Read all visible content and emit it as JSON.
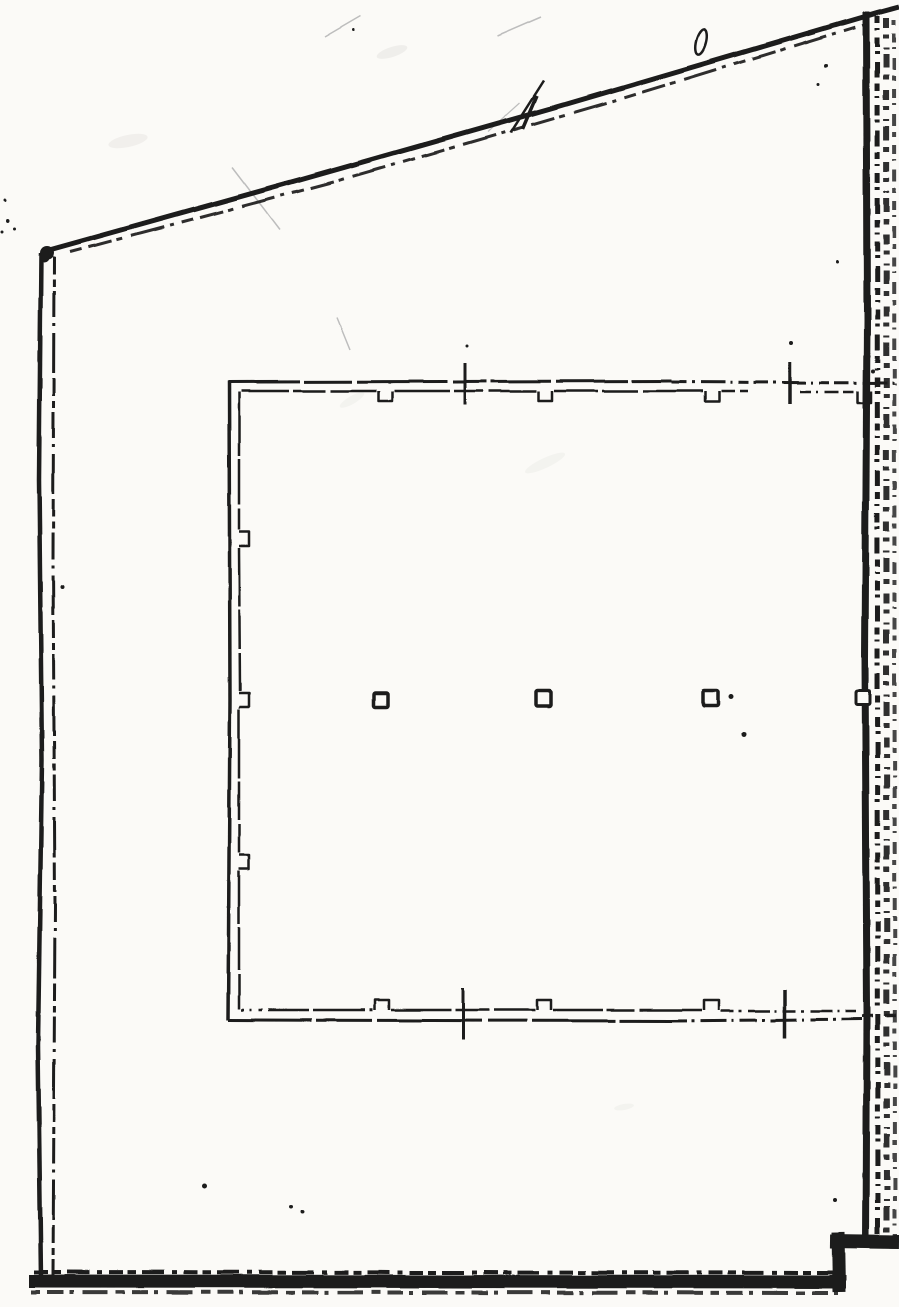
{
  "document": {
    "title": "Scanned architectural floor plan sketch",
    "description": "Photocopied hand-drafted plan: outer boundary with sloped top line, thick textured right and bottom walls, inner slab outline with formwork notches, three column squares and section tick marks. No text labels visible."
  },
  "canvas": {
    "width": 899,
    "height": 1307
  },
  "colors": {
    "paper": "#fbfaf7",
    "ink": "#1b1b1b",
    "scratch": "#bdbdbd",
    "smudge": "#d9d8d3"
  },
  "drawing": {
    "strokes": [
      {
        "n": "left-wall-outer-line",
        "d": "M41,253 L39,480 L42,760 L38,1045 L41,1279",
        "w": 4.5
      },
      {
        "n": "left-wall-inner-line",
        "d": "M54,257 L53,560 L55,905 L53,1276",
        "w": 3,
        "dash": "18 5 7 4 26 6 3 7 40 5"
      },
      {
        "n": "roof-line-main",
        "d": "M42,252 L300,180 L560,106 L877,13 L899,7",
        "w": 5
      },
      {
        "n": "roof-line-rough",
        "d": "M70,252 L330,183 L610,102 L866,24",
        "w": 3,
        "dash": "12 7 24 5 6 9 34 6 4 8",
        "o": 0.9
      },
      {
        "n": "right-wall-core",
        "d": "M866,12 L867,320 L865,660 L867,1010 L866,1246",
        "w": 7
      },
      {
        "n": "right-wall-texture-1",
        "d": "M877,16 L878,1245",
        "w": 5,
        "dash": "7 5 2 7 10 4 3 8 16 6"
      },
      {
        "n": "right-wall-texture-2",
        "d": "M886,18 L887,1243",
        "w": 6,
        "dash": "10 6 4 9 2 5 14 7 5 10",
        "o": 0.92
      },
      {
        "n": "right-wall-texture-3",
        "d": "M894,20 L895,1238",
        "w": 4,
        "dash": "5 8 9 5 2 9 12 6",
        "o": 0.8
      },
      {
        "n": "bottom-wall-core",
        "d": "M29,1281 L846,1282",
        "w": 13
      },
      {
        "n": "bottom-wall-texture-top",
        "d": "M34,1272 L842,1273",
        "w": 4,
        "dash": "14 5 8 6 22 8 5 7"
      },
      {
        "n": "bottom-wall-texture-bottom",
        "d": "M31,1292 L838,1293",
        "w": 4,
        "dash": "9 7 16 6 4 9 26 8",
        "o": 0.85
      },
      {
        "n": "bottom-step-riser",
        "d": "M838,1232 L839,1292",
        "w": 13
      },
      {
        "n": "bottom-step-ledge",
        "d": "M830,1241 L899,1242",
        "w": 14
      },
      {
        "n": "slab-top-outer-line",
        "d": "M228,382 L672,381",
        "w": 3,
        "dash": "72 4 48 5 90 6 34 4 60 5"
      },
      {
        "n": "slab-top-centerline",
        "d": "M672,382 L899,383",
        "w": 3,
        "dash": "15 5 3 6 24 5 2 6 10 5"
      },
      {
        "n": "slab-top-inner-a",
        "d": "M241,391 L376,391",
        "w": 2.5,
        "dash": "48 4 32 5 64 4"
      },
      {
        "n": "slab-top-inner-b",
        "d": "M394,391 L536,391",
        "w": 2.5,
        "dash": "56 4 30 5 70 4"
      },
      {
        "n": "slab-top-inner-c",
        "d": "M554,391 L703,391",
        "w": 2.5,
        "dash": "44 4 36 5 80 4"
      },
      {
        "n": "slab-top-inner-d",
        "d": "M721,391 L748,391",
        "w": 2.5,
        "dash": "14 5 8 4"
      },
      {
        "n": "slab-top-inner-e",
        "d": "M800,392 L856,392",
        "w": 2.5,
        "dash": "11 5 2 6 14 5"
      },
      {
        "n": "slab-left-outer-line",
        "d": "M229,381 L230,700 L228,1020",
        "w": 3.5
      },
      {
        "n": "slab-left-inner-a",
        "d": "M239,392 L239,530",
        "w": 2.5,
        "dash": "64 3 46 4"
      },
      {
        "n": "slab-left-inner-b",
        "d": "M239,548 L240,691",
        "w": 2.5,
        "dash": "58 3 40 4"
      },
      {
        "n": "slab-left-inner-c",
        "d": "M239,709 L239,853",
        "w": 2.5,
        "dash": "70 3 38 4"
      },
      {
        "n": "slab-left-inner-d",
        "d": "M239,871 L239,1009",
        "w": 2.5,
        "dash": "52 3 44 4"
      },
      {
        "n": "slab-bottom-inner-a",
        "d": "M241,1010 L373,1010",
        "w": 2.5,
        "dash": "3 6 2 7 4 6 40 4 52 5"
      },
      {
        "n": "slab-bottom-inner-b",
        "d": "M391,1010 L535,1010",
        "w": 2.5,
        "dash": "60 4 34 5 48 4"
      },
      {
        "n": "slab-bottom-inner-c",
        "d": "M553,1010 L702,1010",
        "w": 2.5,
        "dash": "50 4 28 5 66 4"
      },
      {
        "n": "slab-bottom-inner-d",
        "d": "M721,1011 L856,1011",
        "w": 2.5,
        "dash": "13 5 3 6 22 5 2 6"
      },
      {
        "n": "slab-bottom-outer-line",
        "d": "M228,1020 L670,1021",
        "w": 3,
        "dash": "84 4 56 5 104 6 40 5"
      },
      {
        "n": "slab-bottom-centerline",
        "d": "M670,1021 L862,1019",
        "w": 3,
        "dash": "17 5 3 6 26 5 2 6"
      },
      {
        "n": "slab-bottom-outer-extension",
        "d": "M862,1016 L899,1015",
        "w": 3,
        "dash": "11 4 3 5"
      },
      {
        "n": "tick-top-left",
        "d": "M465,363 L465,405",
        "w": 3
      },
      {
        "n": "tick-top-right",
        "d": "M790,362 L790,404",
        "w": 3.5
      },
      {
        "n": "tick-bottom-left",
        "d": "M463,988 L463,1040",
        "w": 3
      },
      {
        "n": "tick-bottom-right",
        "d": "M785,990 L785,1038",
        "w": 3.5
      },
      {
        "n": "pen-slash-long",
        "d": "M511,133 L544,81",
        "w": 2.5
      },
      {
        "n": "pen-slash-short",
        "d": "M523,129 L537,96",
        "w": 3.5
      }
    ],
    "notches": [
      {
        "n": "slab-top-notch-1",
        "d": "M378,391 L378,401 L392,401 L392,391",
        "w": 2.5
      },
      {
        "n": "slab-top-notch-2",
        "d": "M538,391 L538,401 L552,401 L552,391",
        "w": 2.5
      },
      {
        "n": "slab-top-notch-3",
        "d": "M705,391 L705,401 L719,401 L719,391",
        "w": 2.5
      },
      {
        "n": "slab-top-notch-4",
        "d": "M858,391 L858,403 L871,403 L871,391",
        "w": 2.5
      },
      {
        "n": "slab-left-notch-1",
        "d": "M239,532 L249,532 L249,546 L239,546",
        "w": 2.5
      },
      {
        "n": "slab-left-notch-2",
        "d": "M239,693 L249,693 L249,707 L239,707",
        "w": 2.5
      },
      {
        "n": "slab-left-notch-3",
        "d": "M239,855 L249,855 L249,869 L239,869",
        "w": 2.5
      },
      {
        "n": "slab-bottom-notch-1",
        "d": "M375,1010 L375,1000 L389,1000 L389,1010",
        "w": 2.5
      },
      {
        "n": "slab-bottom-notch-2",
        "d": "M537,1010 L537,1000 L551,1000 L551,1010",
        "w": 2.5
      },
      {
        "n": "slab-bottom-notch-3",
        "d": "M704,1010 L704,1000 L719,1000 L719,1010",
        "w": 2.5
      }
    ],
    "rects": [
      {
        "n": "column-square-1",
        "x": 374,
        "y": 693,
        "w": 14,
        "h": 14,
        "sw": 3.5
      },
      {
        "n": "column-square-2",
        "x": 536,
        "y": 691,
        "w": 15,
        "h": 15,
        "sw": 3.5
      },
      {
        "n": "column-square-3",
        "x": 703,
        "y": 691,
        "w": 15,
        "h": 15,
        "sw": 3.5
      },
      {
        "n": "wall-notch-square",
        "x": 856,
        "y": 691,
        "w": 14,
        "h": 14,
        "sw": 3
      }
    ],
    "dots": [
      [
        8,
        221,
        2
      ],
      [
        15,
        229,
        1.5
      ],
      [
        5,
        200,
        1.5
      ],
      [
        2,
        232,
        1.5
      ],
      [
        47,
        253,
        7
      ],
      [
        44,
        258,
        5
      ],
      [
        62,
        587,
        2
      ],
      [
        205,
        1186,
        2.5
      ],
      [
        291,
        1207,
        2
      ],
      [
        303,
        1212,
        2
      ],
      [
        731,
        697,
        2.5
      ],
      [
        744,
        734,
        2.5
      ],
      [
        826,
        66,
        2
      ],
      [
        818,
        85,
        1.5
      ],
      [
        791,
        343,
        2
      ],
      [
        467,
        346,
        1.5
      ],
      [
        835,
        1200,
        2
      ],
      [
        354,
        30,
        1.5
      ],
      [
        838,
        262,
        1.5
      ],
      [
        873,
        371,
        2
      ]
    ],
    "scratches": [
      {
        "n": "scratch-1",
        "x1": 325,
        "y1": 37,
        "x2": 361,
        "y2": 16,
        "w": 1.5
      },
      {
        "n": "scratch-2",
        "x1": 497,
        "y1": 36,
        "x2": 541,
        "y2": 17,
        "w": 1.5
      },
      {
        "n": "scratch-3",
        "x1": 232,
        "y1": 167,
        "x2": 280,
        "y2": 230,
        "w": 1.5
      },
      {
        "n": "scratch-4",
        "x1": 337,
        "y1": 318,
        "x2": 350,
        "y2": 350,
        "w": 1.5
      },
      {
        "n": "scratch-5",
        "x1": 488,
        "y1": 132,
        "x2": 520,
        "y2": 103,
        "w": 1.2
      }
    ],
    "smudges": [
      {
        "n": "smudge-1",
        "cx": 392,
        "cy": 52,
        "rx": 16,
        "ry": 5,
        "rot": -18,
        "o": 0.35
      },
      {
        "n": "smudge-2",
        "cx": 128,
        "cy": 141,
        "rx": 20,
        "ry": 6,
        "rot": -12,
        "o": 0.3
      },
      {
        "n": "smudge-3",
        "cx": 545,
        "cy": 463,
        "rx": 22,
        "ry": 5,
        "rot": -25,
        "o": 0.2
      },
      {
        "n": "smudge-4",
        "cx": 352,
        "cy": 400,
        "rx": 14,
        "ry": 4,
        "rot": -30,
        "o": 0.2
      },
      {
        "n": "smudge-5",
        "cx": 624,
        "cy": 1107,
        "rx": 10,
        "ry": 3,
        "rot": -10,
        "o": 0.2
      }
    ],
    "loops": [
      {
        "n": "pen-loop-mark",
        "cx": 701,
        "cy": 42,
        "rx": 5,
        "ry": 13,
        "rot": 14,
        "w": 2.5
      }
    ]
  }
}
